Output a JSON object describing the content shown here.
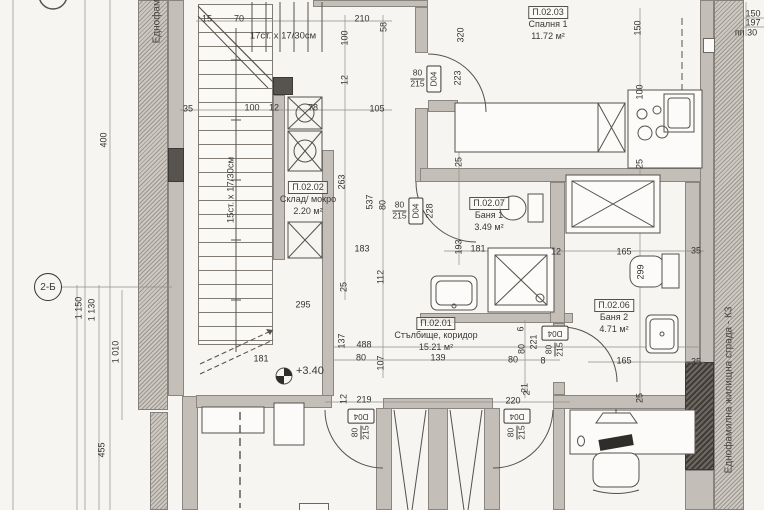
{
  "site": {
    "left_label": "Еднофамилна",
    "right_label": "Еднофамилна жилищна сграда - К3"
  },
  "grid": {
    "row_label": "2-Б"
  },
  "level": {
    "value": "+3.40"
  },
  "stairs": {
    "upper_label": "17ст. х 17/30см",
    "lower_label": "15ст. х 17/30см"
  },
  "rooms": [
    {
      "id": "П.02.03",
      "name": "Спалня 1",
      "area": "11.72 м²"
    },
    {
      "id": "П.02.02",
      "name": "Склад/ мокро",
      "area": "2.20 м²"
    },
    {
      "id": "П.02.07",
      "name": "Баня 1",
      "area": "3.49 м²"
    },
    {
      "id": "П.02.01",
      "name": "Стълбище, коридор",
      "area": "15.21 м²"
    },
    {
      "id": "П.02.06",
      "name": "Баня 2",
      "area": "4.71 м²"
    }
  ],
  "doors": [
    {
      "num": "80",
      "den": "215",
      "code": "D04"
    },
    {
      "num": "80",
      "den": "215",
      "code": "D04"
    },
    {
      "num": "80",
      "den": "215",
      "code": "D04"
    },
    {
      "num": "80",
      "den": "215",
      "code": "D04"
    },
    {
      "num": "80",
      "den": "215",
      "code": "D04"
    }
  ],
  "dims": [
    {
      "t": "15",
      "x": 207,
      "y": 19
    },
    {
      "t": "70",
      "x": 239,
      "y": 19
    },
    {
      "t": "210",
      "x": 362,
      "y": 19
    },
    {
      "t": "58",
      "x": 384,
      "y": 27,
      "v": 1
    },
    {
      "t": "100",
      "x": 345,
      "y": 38,
      "v": 1
    },
    {
      "t": "320",
      "x": 461,
      "y": 35,
      "v": 1
    },
    {
      "t": "150",
      "x": 638,
      "y": 28,
      "v": 1
    },
    {
      "t": "100",
      "x": 640,
      "y": 92,
      "v": 1
    },
    {
      "t": "35",
      "x": 188,
      "y": 109
    },
    {
      "t": "100",
      "x": 252,
      "y": 108
    },
    {
      "t": "12",
      "x": 274,
      "y": 108
    },
    {
      "t": "78",
      "x": 313,
      "y": 108
    },
    {
      "t": "105",
      "x": 377,
      "y": 109
    },
    {
      "t": "12",
      "x": 345,
      "y": 80,
      "v": 1
    },
    {
      "t": "223",
      "x": 458,
      "y": 78,
      "v": 1
    },
    {
      "t": "263",
      "x": 342,
      "y": 182,
      "v": 1
    },
    {
      "t": "537",
      "x": 370,
      "y": 202,
      "v": 1
    },
    {
      "t": "80",
      "x": 383,
      "y": 205,
      "v": 1
    },
    {
      "t": "228",
      "x": 430,
      "y": 211,
      "v": 1
    },
    {
      "t": "25",
      "x": 459,
      "y": 162,
      "v": 1
    },
    {
      "t": "25",
      "x": 640,
      "y": 164,
      "v": 1
    },
    {
      "t": "193",
      "x": 459,
      "y": 247,
      "v": 1
    },
    {
      "t": "181",
      "x": 478,
      "y": 249
    },
    {
      "t": "12",
      "x": 556,
      "y": 252
    },
    {
      "t": "165",
      "x": 624,
      "y": 252
    },
    {
      "t": "35",
      "x": 696,
      "y": 251
    },
    {
      "t": "299",
      "x": 641,
      "y": 272,
      "v": 1
    },
    {
      "t": "183",
      "x": 362,
      "y": 249
    },
    {
      "t": "112",
      "x": 381,
      "y": 277,
      "v": 1
    },
    {
      "t": "25",
      "x": 344,
      "y": 287,
      "v": 1
    },
    {
      "t": "295",
      "x": 303,
      "y": 305
    },
    {
      "t": "137",
      "x": 342,
      "y": 341,
      "v": 1
    },
    {
      "t": "488",
      "x": 364,
      "y": 345
    },
    {
      "t": "80",
      "x": 361,
      "y": 358
    },
    {
      "t": "107",
      "x": 381,
      "y": 363,
      "v": 1
    },
    {
      "t": "139",
      "x": 438,
      "y": 358
    },
    {
      "t": "80",
      "x": 513,
      "y": 360
    },
    {
      "t": "8",
      "x": 543,
      "y": 361
    },
    {
      "t": "6",
      "x": 521,
      "y": 329,
      "v": 1
    },
    {
      "t": "221",
      "x": 534,
      "y": 342,
      "v": 1
    },
    {
      "t": "80",
      "x": 522,
      "y": 349,
      "v": 1
    },
    {
      "t": "21",
      "x": 525,
      "y": 388,
      "v": 1
    },
    {
      "t": "165",
      "x": 624,
      "y": 361
    },
    {
      "t": "35",
      "x": 696,
      "y": 362
    },
    {
      "t": "181",
      "x": 261,
      "y": 359
    },
    {
      "t": "12",
      "x": 344,
      "y": 399,
      "v": 1
    },
    {
      "t": "219",
      "x": 364,
      "y": 400
    },
    {
      "t": "2",
      "x": 527,
      "y": 393,
      "v": 1
    },
    {
      "t": "220",
      "x": 513,
      "y": 401
    },
    {
      "t": "25",
      "x": 640,
      "y": 398,
      "v": 1
    },
    {
      "t": "400",
      "x": 104,
      "y": 140,
      "v": 1
    },
    {
      "t": "1 150",
      "x": 79,
      "y": 308,
      "v": 1
    },
    {
      "t": "1 130",
      "x": 92,
      "y": 310,
      "v": 1
    },
    {
      "t": "1 010",
      "x": 116,
      "y": 352,
      "v": 1
    },
    {
      "t": "455",
      "x": 102,
      "y": 450,
      "v": 1
    },
    {
      "t": "150",
      "x": 753,
      "y": 14
    },
    {
      "t": "197",
      "x": 753,
      "y": 23
    },
    {
      "t": "пп 30",
      "x": 746,
      "y": 33
    }
  ]
}
